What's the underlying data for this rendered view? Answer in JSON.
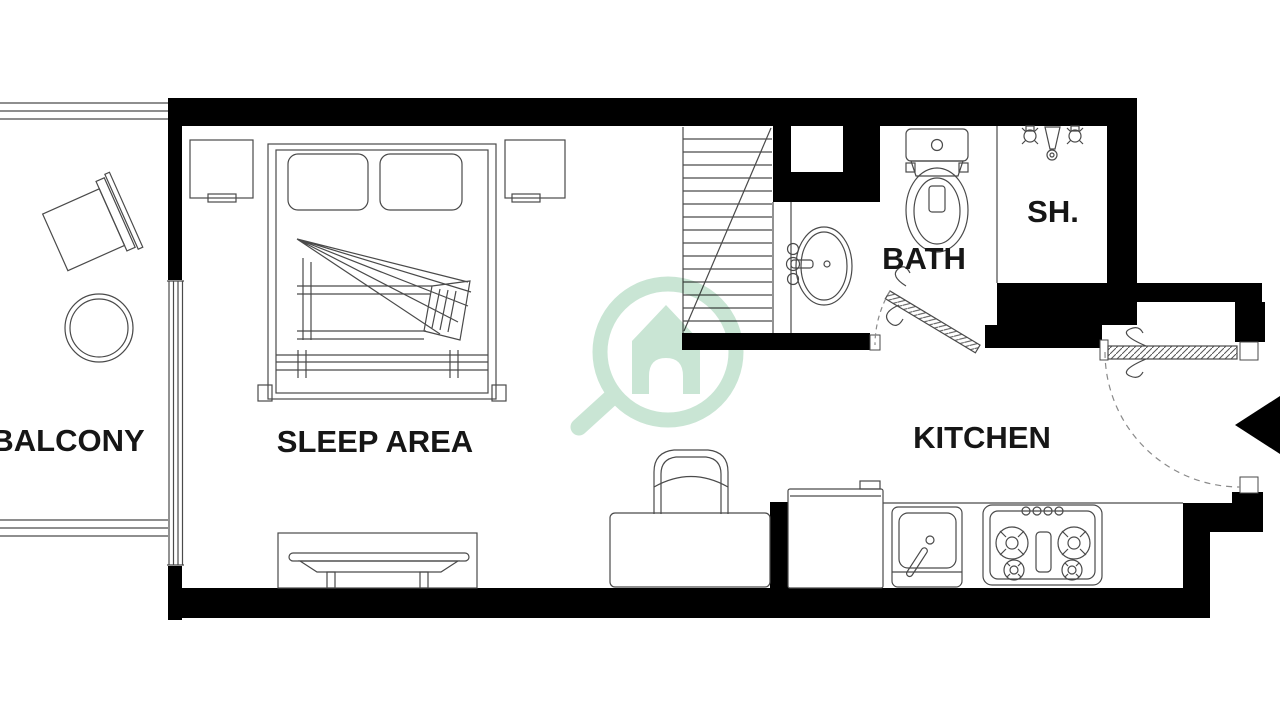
{
  "title": "Studio apartment floor plan",
  "rooms": [
    {
      "id": "balcony",
      "label": "BALCONY"
    },
    {
      "id": "sleep-area",
      "label": "SLEEP AREA"
    },
    {
      "id": "bath",
      "label": "BATH"
    },
    {
      "id": "shower",
      "label": "SH."
    },
    {
      "id": "kitchen",
      "label": "KITCHEN"
    }
  ],
  "colors": {
    "walls": "#000000",
    "lines": "#4a4a4a",
    "dashed": "#8a8a8a",
    "watermark_green": "#c9e5d4",
    "background": "#ffffff"
  },
  "watermark": {
    "icon": "house-search-logo"
  },
  "fixtures": [
    "double-bed",
    "pillow",
    "nightstand-left",
    "nightstand-right",
    "bench",
    "balcony-chair",
    "balcony-round-table",
    "balcony-railing",
    "window",
    "stairs",
    "bathroom-basin",
    "toilet",
    "shower-heads",
    "bath-door",
    "entrance-door",
    "entrance-arrow",
    "desk",
    "desk-chair",
    "fridge",
    "kitchen-sink",
    "stove",
    "kitchen-counter"
  ]
}
